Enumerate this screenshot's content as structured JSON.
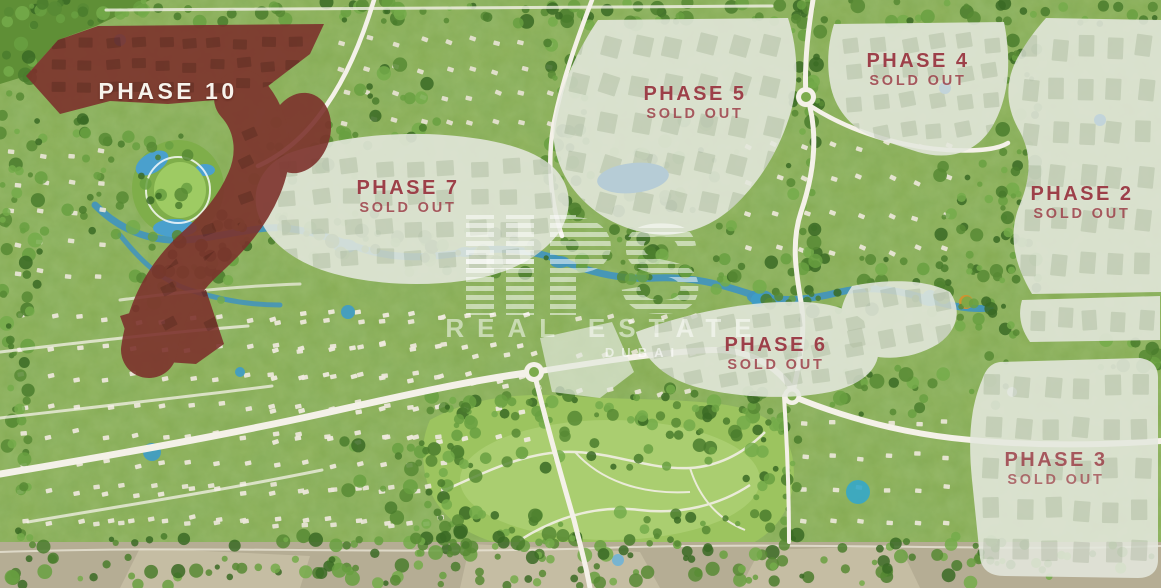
{
  "phases": [
    {
      "id": "phase-10",
      "name": "PHASE 10",
      "status": ""
    },
    {
      "id": "phase-7",
      "name": "PHASE 7",
      "status": "SOLD OUT"
    },
    {
      "id": "phase-5",
      "name": "PHASE 5",
      "status": "SOLD OUT"
    },
    {
      "id": "phase-4",
      "name": "PHASE 4",
      "status": "SOLD OUT"
    },
    {
      "id": "phase-2",
      "name": "PHASE 2",
      "status": "SOLD OUT"
    },
    {
      "id": "phase-6",
      "name": "PHASE 6",
      "status": "SOLD OUT"
    },
    {
      "id": "phase-3",
      "name": "PHASE 3",
      "status": "SOLD OUT"
    }
  ],
  "watermark": {
    "monogram": "S",
    "brand_line": "REAL ESTATE",
    "city_line": "DUBAI"
  },
  "colors": {
    "phase_label": "#9d4049",
    "phase10_label": "#f7f3ec",
    "phase10_overlay": "#7d322d",
    "soldout_overlay": "#e4e8dd",
    "water": "#3f93c0",
    "park_green": "#9cc45f"
  }
}
